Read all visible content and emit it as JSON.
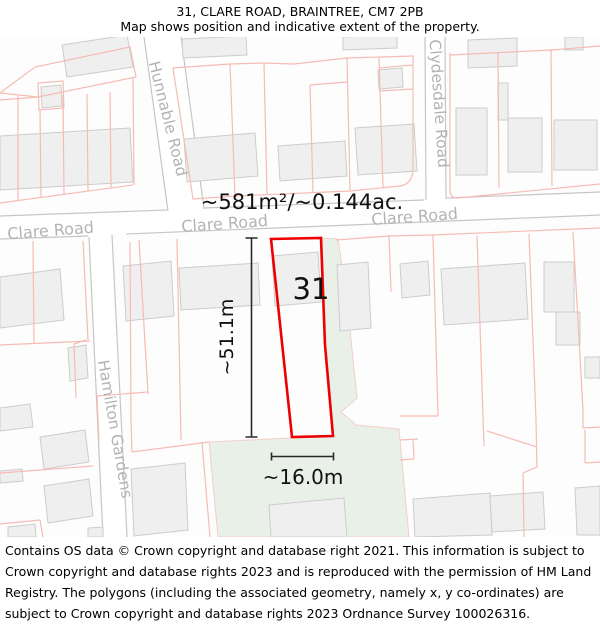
{
  "header": {
    "title": "31, CLARE ROAD, BRAINTREE, CM7 2PB",
    "subtitle": "Map shows position and indicative extent of the property."
  },
  "map": {
    "area_label": "~581m²/~0.144ac.",
    "plot_number": "31",
    "height_label": "~51.1m",
    "width_label": "~16.0m",
    "roads": {
      "clare_left": "Clare Road",
      "clare_center": "Clare Road",
      "clare_right": "Clare Road",
      "hunnable": "Hunnable Road",
      "clydesdale": "Clydesdale Road",
      "hamilton": "Hamilton Gardens"
    },
    "colors": {
      "property_outline": "#ee0000",
      "parcel_line": "#f5bcb4",
      "building_fill": "#f0efef",
      "building_stroke": "#cccccc",
      "road_edge": "#c6c6c6",
      "road_label": "#b3b3b3",
      "green_area": "#e9f0e8",
      "green_edge": "#f3cfc8",
      "annotation": "#2a2a2a"
    }
  },
  "footer": {
    "text": "Contains OS data © Crown copyright and database right 2021. This information is subject to Crown copyright and database rights 2023 and is reproduced with the permission of HM Land Registry. The polygons (including the associated geometry, namely x, y co-ordinates) are subject to Crown copyright and database rights 2023 Ordnance Survey 100026316."
  }
}
